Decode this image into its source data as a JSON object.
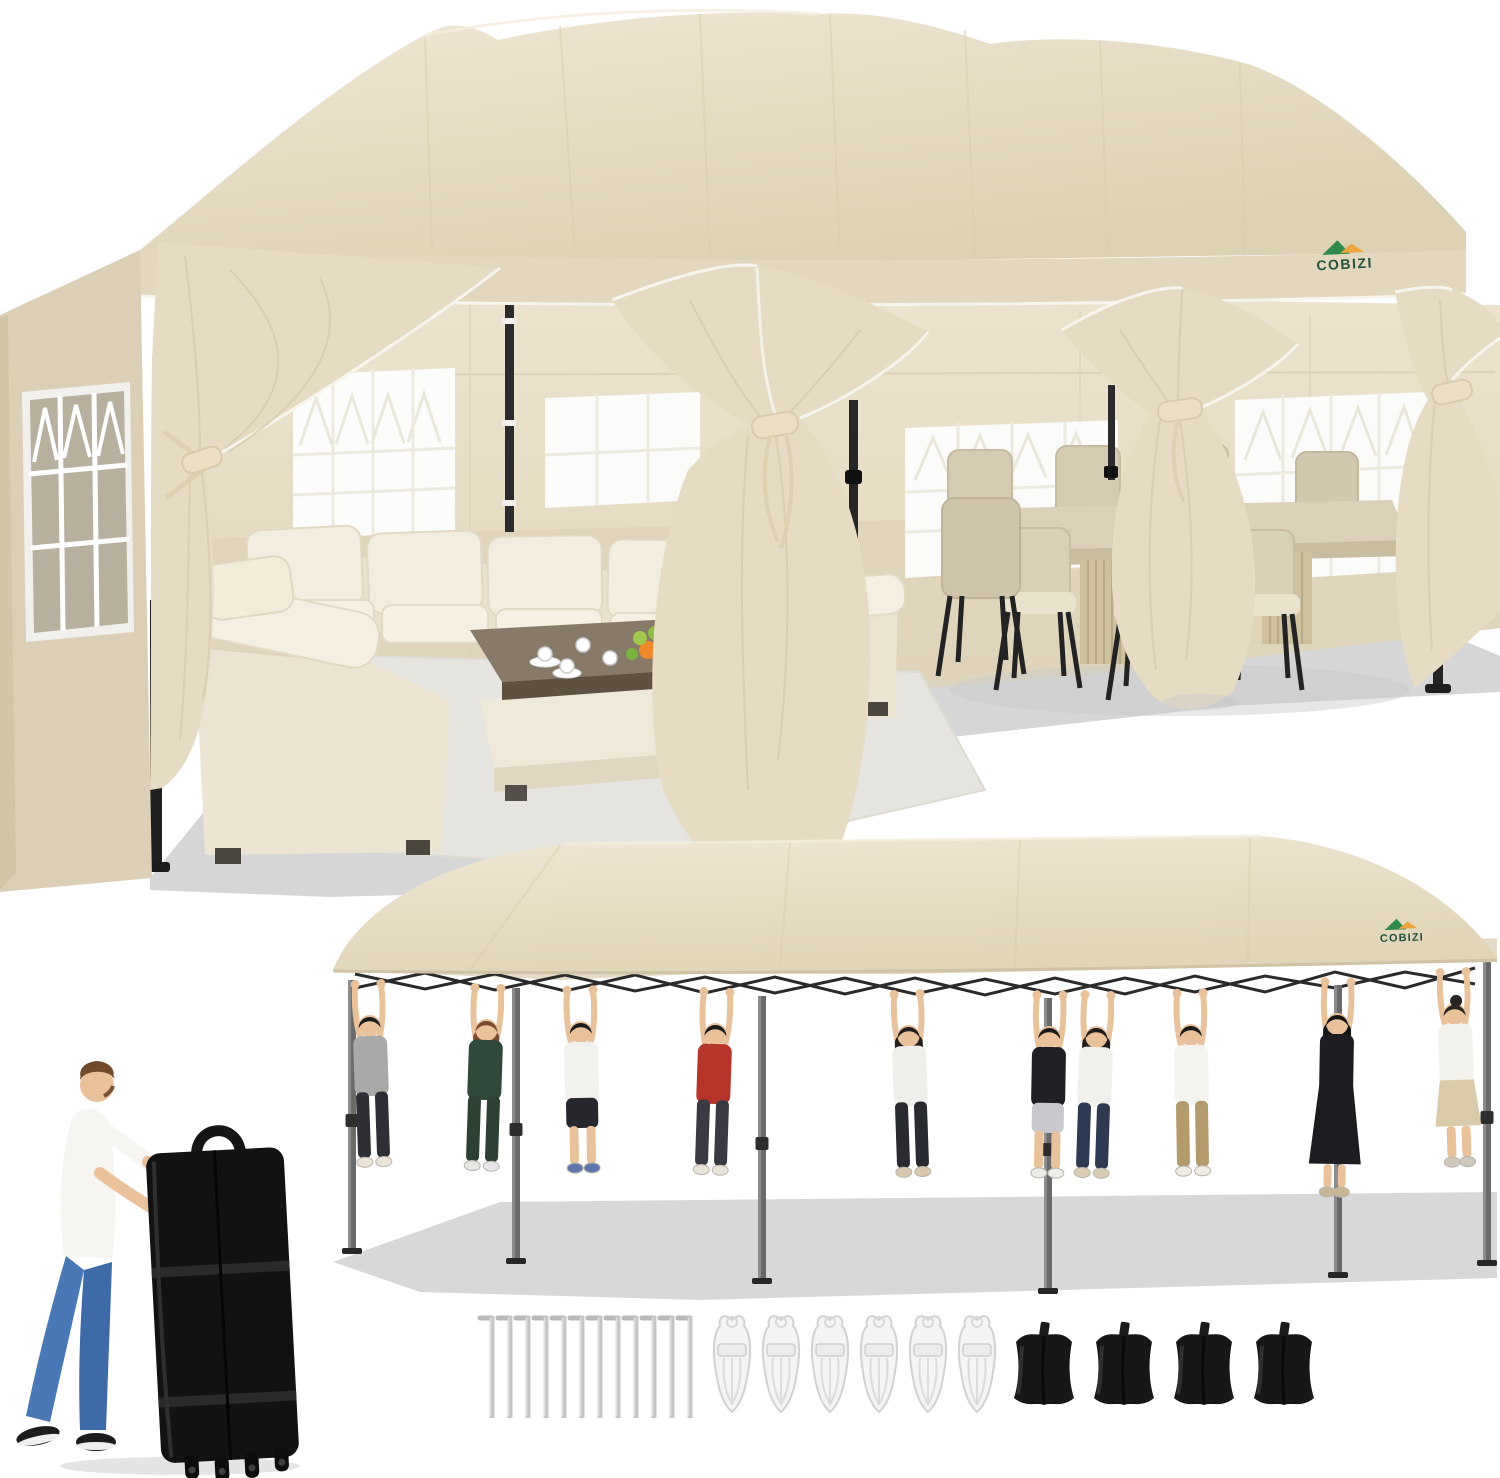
{
  "brand": {
    "name": "COBIZI"
  },
  "colors": {
    "canopy": "#eae1cb",
    "canopy_shade": "#dbcfb2",
    "valance": "#e3d8be",
    "side_wall": "#dbd0b5",
    "back_wall": "#e9e0ca",
    "back_wall_lower": "#ded3b8",
    "curtain": "#e6dcc4",
    "curtain_fold": "#d6caab",
    "trim_piping": "#f8f5ec",
    "frame_dark": "#262626",
    "pole_silver": "#6a6a6a",
    "floor_shadow": "#d6d6d6",
    "rug": "#e7e5e0",
    "sofa_cream": "#f2edde",
    "table_top": "#877a68",
    "logo_green": "#2f8a4e",
    "logo_orange": "#f0a43c",
    "logo_text": "#23513a",
    "bag_black": "#121212",
    "rope_white": "#f4f4f4",
    "sandbag_black": "#171717",
    "stake_silver": "#c6c6c6",
    "skin": "#e9c29c",
    "jeans_blue": "#4a77b5"
  },
  "scene_strength": {
    "people_count": 10,
    "people": [
      {
        "x": 368,
        "by": 152,
        "rot": -2,
        "top": "#a9a9a7",
        "bottom": "#2e2e35",
        "style": "pants",
        "hair": "#1e1c1a",
        "hair_style": "short",
        "shoes": "#e9e5db"
      },
      {
        "x": 488,
        "by": 156,
        "rot": 2,
        "top": "#31493a",
        "bottom": "#2c4134",
        "style": "pants",
        "hair": "#7a4a2e",
        "hair_style": "medium",
        "shoes": "#e6e6e6"
      },
      {
        "x": 580,
        "by": 158,
        "rot": -1,
        "top": "#f2f1ee",
        "bottom": "#26262d",
        "style": "shorts",
        "hair": "#1e1c1a",
        "hair_style": "short",
        "shoes": "#5d76ad"
      },
      {
        "x": 717,
        "by": 160,
        "rot": 2,
        "top": "#b5352a",
        "bottom": "#3a3a42",
        "style": "pants",
        "hair": "#1e1c1a",
        "hair_style": "short",
        "shoes": "#e8e4da"
      },
      {
        "x": 907,
        "by": 162,
        "rot": -2,
        "top": "#efeeea",
        "bottom": "#2a2a31",
        "style": "pants",
        "hair": "#241f1d",
        "hair_style": "long",
        "shoes": "#d8c9ae"
      },
      {
        "x": 1050,
        "by": 163,
        "rot": 1,
        "top": "#202024",
        "bottom": "#c9c9cd",
        "style": "shorts",
        "hair": "#1e1c1a",
        "hair_style": "short",
        "shoes": "#ededeb"
      },
      {
        "x": 1098,
        "by": 163,
        "rot": 2,
        "top": "#f1f0ec",
        "bottom": "#2e3a52",
        "style": "pants",
        "hair": "#221d1b",
        "hair_style": "long",
        "shoes": "#d9cdb4"
      },
      {
        "x": 1190,
        "by": 161,
        "rot": -1,
        "top": "#f4f3f0",
        "bottom": "#b39b6e",
        "style": "pants",
        "hair": "#1e1c1a",
        "hair_style": "short",
        "shoes": "#efece4"
      },
      {
        "x": 1338,
        "by": 150,
        "rot": 1,
        "top": "#1d1d21",
        "bottom": "#1d1d21",
        "style": "dress",
        "hair": "#141414",
        "hair_style": "long",
        "shoes": "#c9b694"
      },
      {
        "x": 1453,
        "by": 140,
        "rot": -2,
        "top": "#f2f1ec",
        "bottom": "#d9caa9",
        "style": "skirt",
        "hair": "#2a2522",
        "hair_style": "bun",
        "shoes": "#cfc9bd"
      }
    ],
    "legs": [
      {
        "x": 352,
        "y1": 150,
        "y2": 418
      },
      {
        "x": 516,
        "y1": 158,
        "y2": 428
      },
      {
        "x": 762,
        "y1": 166,
        "y2": 448
      },
      {
        "x": 1048,
        "y1": 168,
        "y2": 458
      },
      {
        "x": 1338,
        "y1": 155,
        "y2": 442
      },
      {
        "x": 1487,
        "y1": 132,
        "y2": 430
      }
    ]
  },
  "accessories": {
    "stakes": {
      "count": 12
    },
    "ropes": {
      "count": 6
    },
    "sandbags": {
      "count": 4
    }
  }
}
